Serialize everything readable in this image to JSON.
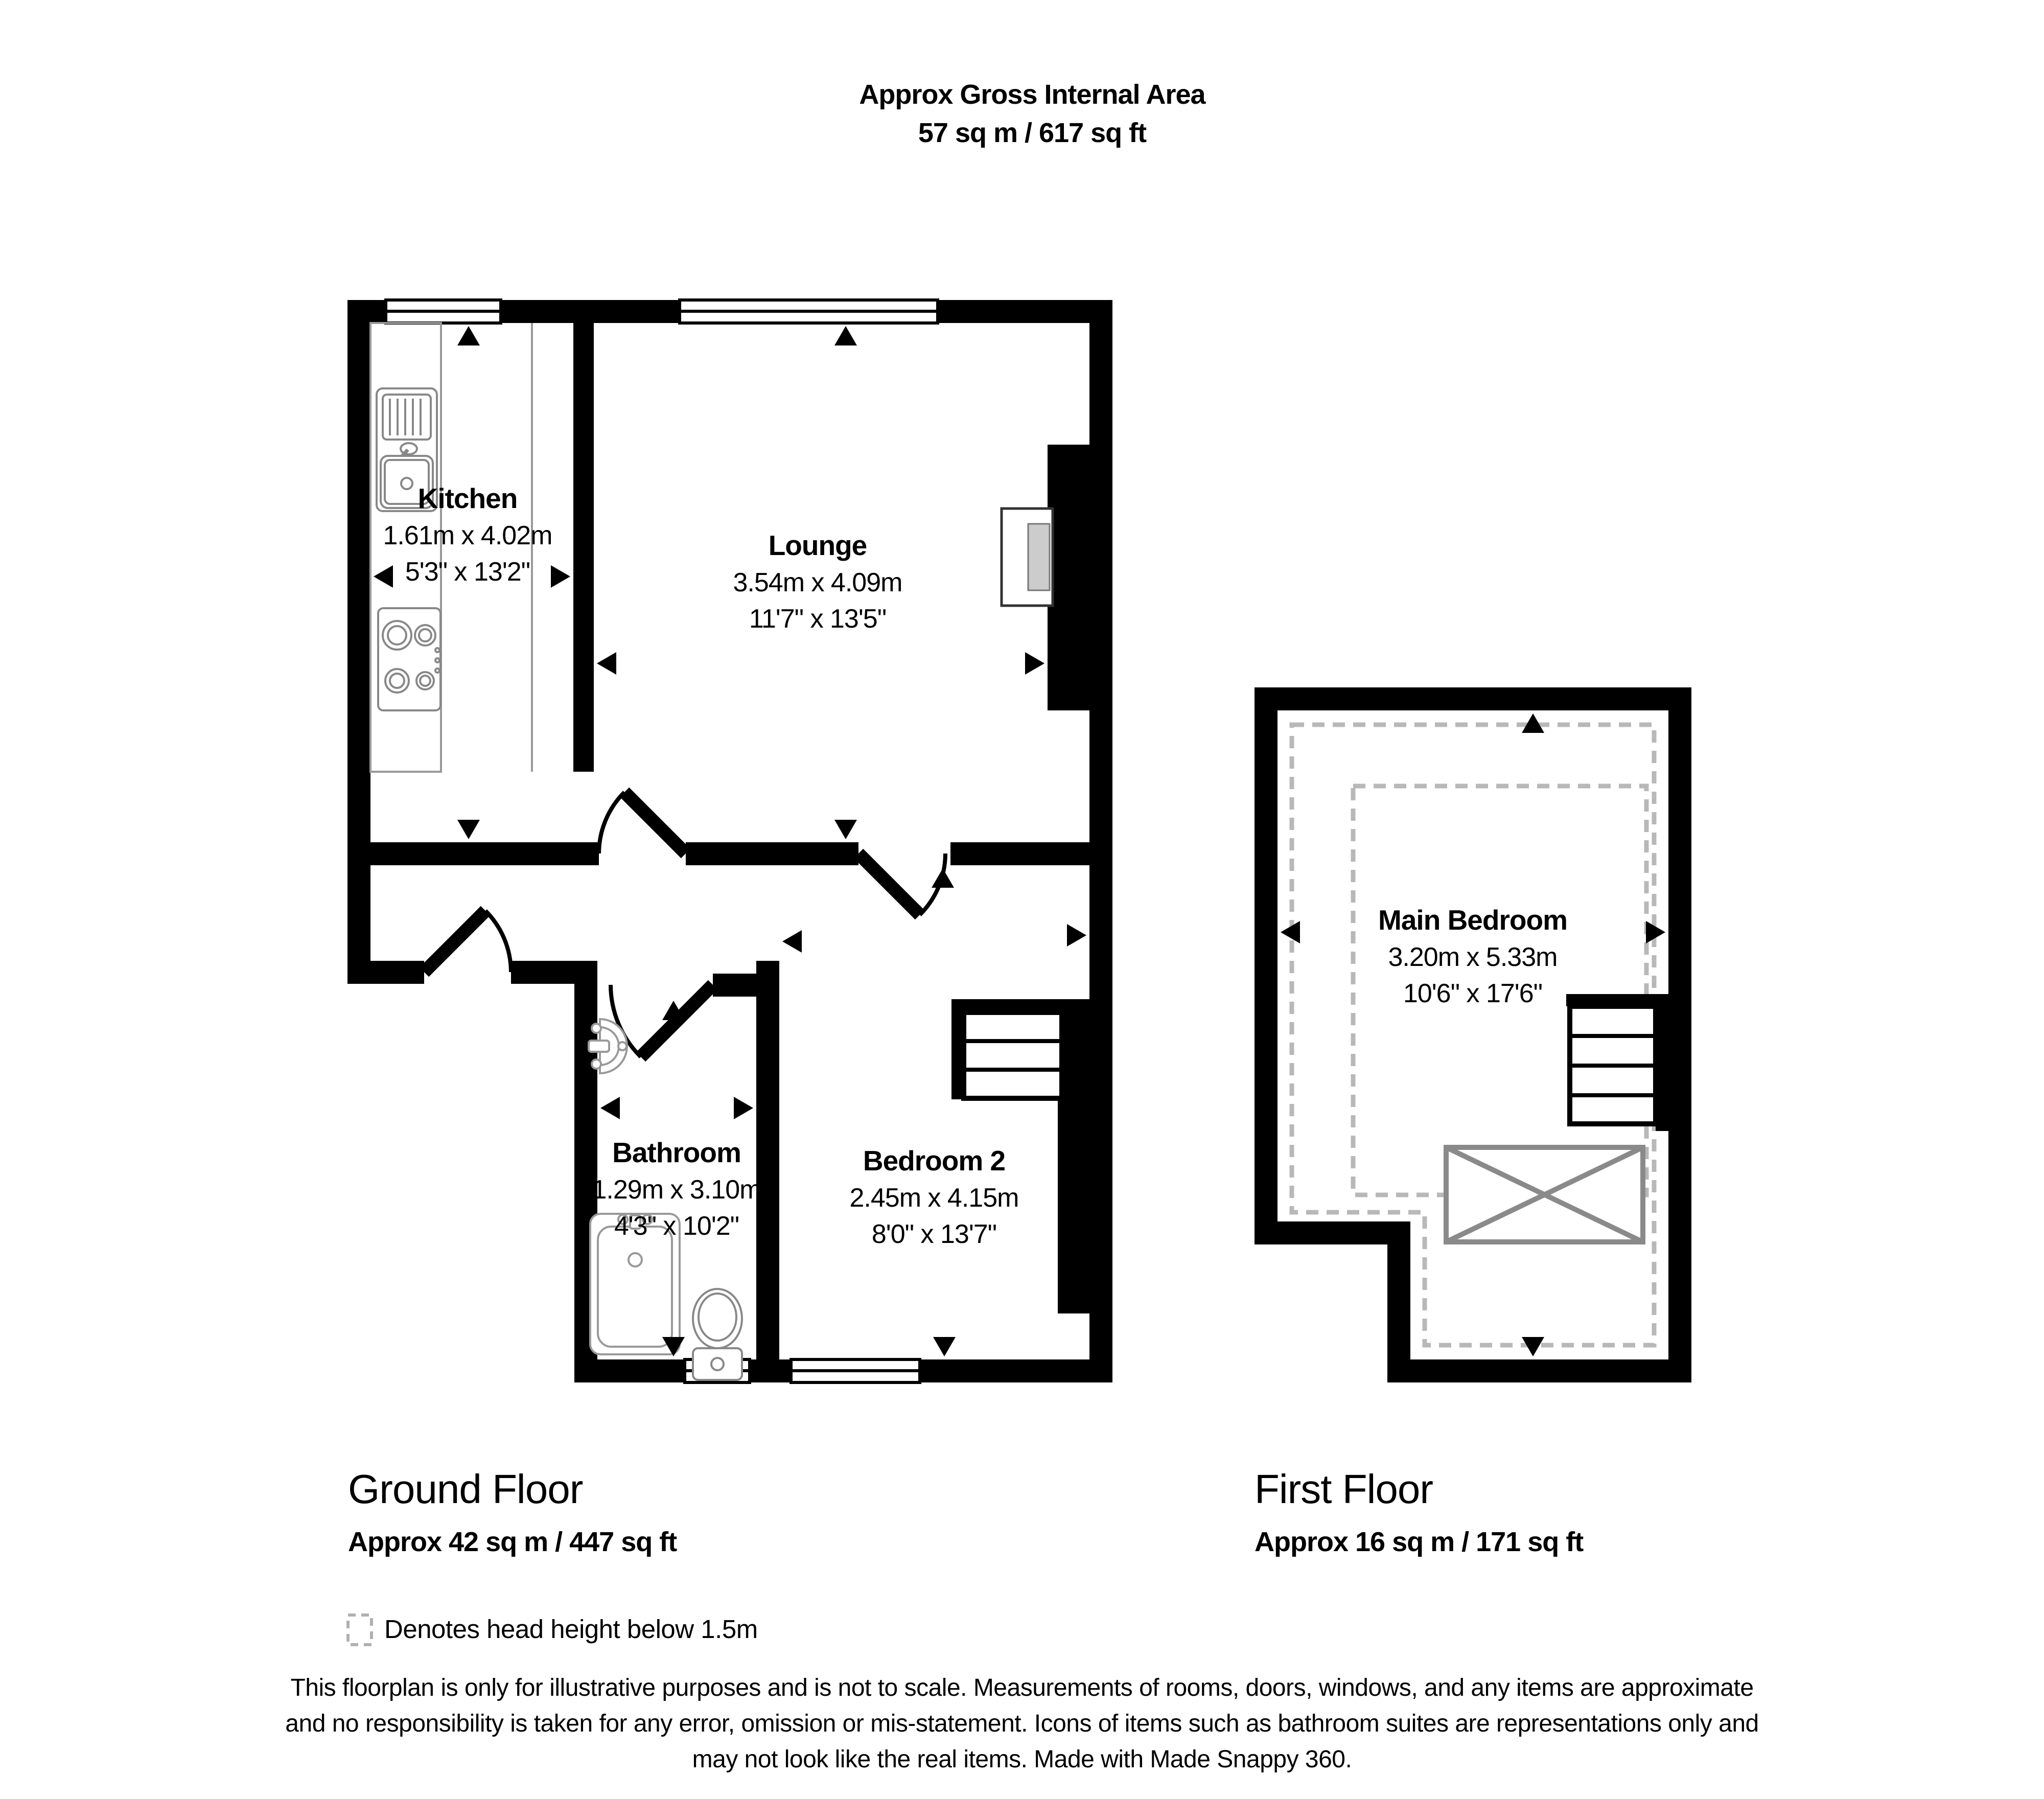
{
  "title": {
    "line1": "Approx Gross Internal Area",
    "line2": "57 sq m / 617 sq ft"
  },
  "rooms": [
    {
      "id": "kitchen",
      "name": "Kitchen",
      "metric": "1.61m x 4.02m",
      "imperial": "5'3\" x 13'2\""
    },
    {
      "id": "lounge",
      "name": "Lounge",
      "metric": "3.54m x 4.09m",
      "imperial": "11'7\" x 13'5\""
    },
    {
      "id": "bathroom",
      "name": "Bathroom",
      "metric": "1.29m x 3.10m",
      "imperial": "4'3\" x 10'2\""
    },
    {
      "id": "bedroom-2",
      "name": "Bedroom 2",
      "metric": "2.45m x 4.15m",
      "imperial": "8'0\" x 13'7\""
    },
    {
      "id": "main-bedroom",
      "name": "Main Bedroom",
      "metric": "3.20m x 5.33m",
      "imperial": "10'6\" x 17'6\""
    }
  ],
  "floors": [
    {
      "label": "Ground Floor",
      "area": "Approx 42 sq m / 447 sq ft"
    },
    {
      "label": "First Floor",
      "area": "Approx 16 sq m / 171 sq ft"
    }
  ],
  "legend": {
    "text": "Denotes head height below 1.5m"
  },
  "disclaimer": {
    "line1": "This floorplan is only for illustrative purposes and is not to scale. Measurements of rooms, doors, windows, and any items are approximate",
    "line2": "and no responsibility is taken for any error, omission or mis-statement. Icons of items such as bathroom suites are representations only and",
    "line3": "may not look like the real items. Made with Made Snappy 360."
  },
  "colors": {
    "wall": "#000000",
    "text": "#000000",
    "fixture_outline": "#999999",
    "head_height_dash": "#b8b8b8"
  }
}
